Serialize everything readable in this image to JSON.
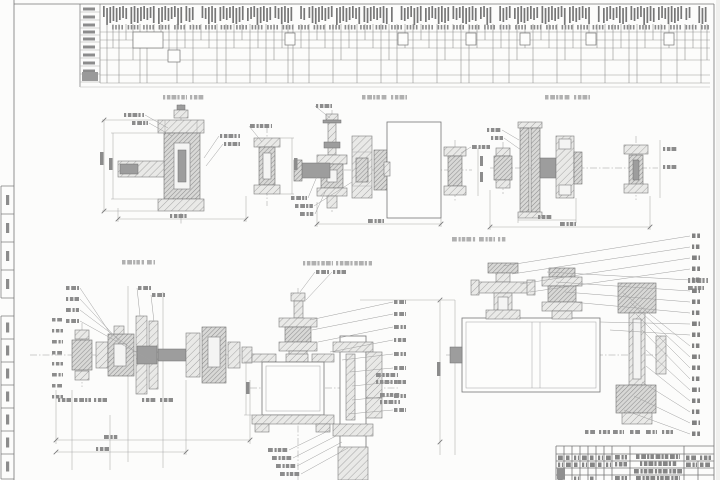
{
  "colors": {
    "paper": "#fcfcfb",
    "outside": "#f0f0ee",
    "line": "#767676",
    "light_line": "#a9a9a9",
    "leader": "#9f9f9f",
    "micro_text": "#777777",
    "micro_text_mid": "#8c8c8c",
    "micro_text_light": "#b0b0b0",
    "grid_row": "#9a9a9a",
    "vertical_line": "#8f8f8f"
  },
  "frame": {
    "left_x": 14,
    "right_x": 714,
    "top_y": 4,
    "margin_strip": {
      "x": 1,
      "width": 13,
      "group1_y": [
        186,
        214,
        242,
        270,
        298
      ],
      "group2_y": [
        316,
        339,
        362,
        385,
        408,
        431,
        454,
        479
      ]
    }
  },
  "cyclogram": {
    "x": 80,
    "label_col_right": 100,
    "right": 710,
    "top": 4,
    "bottom": 83,
    "label_rows": [
      12,
      20,
      28,
      35,
      42,
      50,
      58,
      66,
      74,
      82
    ],
    "text_band": {
      "x1": 103,
      "x2": 708,
      "y": 6,
      "height": 17
    },
    "band2": {
      "y": 25,
      "height": 4.5
    },
    "row_lines": [
      32,
      40,
      48,
      60,
      75,
      83
    ],
    "verticals": [
      [
        107,
        83
      ],
      [
        113,
        48
      ],
      [
        119,
        83
      ],
      [
        126,
        40
      ],
      [
        133,
        60
      ],
      [
        140,
        83
      ],
      [
        147,
        83
      ],
      [
        154,
        48
      ],
      [
        161,
        40
      ],
      [
        169,
        62
      ],
      [
        177,
        83
      ],
      [
        185,
        48
      ],
      [
        193,
        83
      ],
      [
        201,
        40
      ],
      [
        209,
        48
      ],
      [
        217,
        83
      ],
      [
        226,
        83
      ],
      [
        234,
        48
      ],
      [
        242,
        40
      ],
      [
        250,
        83
      ],
      [
        258,
        48
      ],
      [
        266,
        83
      ],
      [
        274,
        60
      ],
      [
        282,
        48
      ],
      [
        288,
        83
      ],
      [
        293,
        83
      ],
      [
        301,
        48
      ],
      [
        309,
        83
      ],
      [
        317,
        40
      ],
      [
        325,
        48
      ],
      [
        333,
        83
      ],
      [
        341,
        60
      ],
      [
        349,
        48
      ],
      [
        357,
        83
      ],
      [
        365,
        40
      ],
      [
        373,
        48
      ],
      [
        381,
        83
      ],
      [
        389,
        60
      ],
      [
        397,
        83
      ],
      [
        405,
        48
      ],
      [
        413,
        83
      ],
      [
        421,
        40
      ],
      [
        429,
        48
      ],
      [
        437,
        83
      ],
      [
        445,
        60
      ],
      [
        453,
        48
      ],
      [
        461,
        83
      ],
      [
        469,
        83
      ],
      [
        477,
        48
      ],
      [
        485,
        40
      ],
      [
        493,
        83
      ],
      [
        501,
        48
      ],
      [
        509,
        83
      ],
      [
        517,
        60
      ],
      [
        525,
        48
      ],
      [
        533,
        83
      ],
      [
        541,
        40
      ],
      [
        549,
        48
      ],
      [
        557,
        83
      ],
      [
        565,
        60
      ],
      [
        573,
        48
      ],
      [
        581,
        83
      ],
      [
        589,
        40
      ],
      [
        597,
        48
      ],
      [
        605,
        83
      ],
      [
        613,
        60
      ],
      [
        621,
        48
      ],
      [
        629,
        83
      ],
      [
        637,
        83
      ],
      [
        645,
        48
      ],
      [
        653,
        40
      ],
      [
        661,
        83
      ],
      [
        669,
        48
      ],
      [
        677,
        83
      ],
      [
        685,
        60
      ],
      [
        693,
        48
      ],
      [
        701,
        83
      ],
      [
        707,
        60
      ]
    ],
    "boxes": [
      [
        133,
        32,
        30,
        16
      ],
      [
        168,
        50,
        12,
        12
      ],
      [
        285,
        33,
        10,
        12
      ],
      [
        398,
        33,
        10,
        12
      ],
      [
        466,
        33,
        10,
        12
      ],
      [
        520,
        33,
        10,
        12
      ],
      [
        586,
        33,
        10,
        12
      ],
      [
        664,
        33,
        10,
        12
      ]
    ],
    "label_block": [
      82,
      72,
      16,
      9
    ]
  },
  "view_titles": [
    {
      "bars": [
        [
          163,
          95,
          24
        ],
        [
          190,
          95,
          14
        ]
      ]
    },
    {
      "bars": [
        [
          362,
          95,
          26
        ],
        [
          391,
          95,
          16
        ]
      ]
    },
    {
      "bars": [
        [
          545,
          95,
          26
        ],
        [
          574,
          95,
          16
        ]
      ]
    },
    {
      "bars": [
        [
          122,
          260,
          22
        ],
        [
          147,
          260,
          8
        ]
      ]
    },
    {
      "bars": [
        [
          303,
          261,
          30
        ],
        [
          336,
          261,
          36
        ]
      ]
    },
    {
      "bars": [
        [
          452,
          237,
          24
        ],
        [
          479,
          237,
          16
        ],
        [
          498,
          237,
          8
        ]
      ]
    }
  ],
  "leaders": [
    {
      "label": [
        124,
        113,
        20
      ],
      "to": [
        168,
        128
      ]
    },
    {
      "label": [
        132,
        121,
        16
      ],
      "to": [
        172,
        136
      ]
    },
    {
      "label": [
        220,
        134,
        20
      ],
      "to": [
        204,
        158
      ]
    },
    {
      "label": [
        224,
        142,
        16
      ],
      "to": [
        206,
        166
      ]
    },
    {
      "label": [
        250,
        124,
        22
      ],
      "to": [
        262,
        142
      ]
    },
    {
      "label": [
        316,
        104,
        16
      ],
      "to": [
        330,
        118
      ]
    },
    {
      "label": [
        291,
        196,
        16
      ],
      "to": [
        318,
        174
      ]
    },
    {
      "label": [
        295,
        204,
        18
      ],
      "to": [
        352,
        182
      ]
    },
    {
      "label": [
        300,
        212,
        14
      ],
      "to": [
        326,
        190
      ]
    },
    {
      "label": [
        472,
        145,
        18
      ],
      "to": [
        461,
        153
      ]
    },
    {
      "label": [
        487,
        128,
        14
      ],
      "to": [
        519,
        140
      ]
    },
    {
      "label": [
        491,
        136,
        12
      ],
      "to": [
        521,
        150
      ]
    },
    {
      "label": [
        66,
        286,
        13
      ],
      "to": [
        112,
        336
      ]
    },
    {
      "label": [
        66,
        297,
        13
      ],
      "to": [
        122,
        344
      ]
    },
    {
      "label": [
        66,
        308,
        13
      ],
      "to": [
        136,
        352
      ]
    },
    {
      "label": [
        66,
        319,
        13
      ],
      "to": [
        150,
        360
      ]
    },
    {
      "label": [
        138,
        286,
        13
      ],
      "to": [
        140,
        316
      ]
    },
    {
      "label": [
        152,
        293,
        13
      ],
      "to": [
        154,
        322
      ]
    },
    {
      "label": [
        316,
        270,
        13
      ],
      "to": [
        300,
        292
      ]
    },
    {
      "label": [
        333,
        270,
        13
      ],
      "to": [
        306,
        300
      ]
    },
    {
      "label": [
        394,
        300,
        12
      ],
      "to": [
        310,
        320
      ]
    },
    {
      "label": [
        394,
        312,
        12
      ],
      "to": [
        312,
        330
      ]
    },
    {
      "label": [
        394,
        325,
        12
      ],
      "to": [
        318,
        342
      ]
    },
    {
      "label": [
        394,
        338,
        12
      ],
      "to": [
        330,
        352
      ]
    },
    {
      "label": [
        394,
        352,
        12
      ],
      "to": [
        342,
        360
      ]
    },
    {
      "label": [
        394,
        366,
        12
      ],
      "to": [
        350,
        372
      ]
    },
    {
      "label": [
        394,
        380,
        12
      ],
      "to": [
        352,
        386
      ]
    },
    {
      "label": [
        394,
        394,
        12
      ],
      "to": [
        352,
        400
      ]
    },
    {
      "label": [
        394,
        408,
        12
      ],
      "to": [
        348,
        414
      ]
    },
    {
      "label": [
        268,
        448,
        20
      ],
      "to": [
        330,
        430
      ]
    },
    {
      "label": [
        272,
        456,
        20
      ],
      "to": [
        336,
        436
      ]
    },
    {
      "label": [
        276,
        464,
        20
      ],
      "to": [
        342,
        442
      ]
    },
    {
      "label": [
        280,
        472,
        20
      ],
      "to": [
        348,
        448
      ]
    }
  ],
  "position_column": {
    "x": 692,
    "items": [
      {
        "y": 236,
        "from": [
          503,
          266
        ]
      },
      {
        "y": 247,
        "from": [
          512,
          274
        ]
      },
      {
        "y": 258,
        "from": [
          520,
          284
        ]
      },
      {
        "y": 269,
        "from": [
          530,
          292
        ]
      },
      {
        "y": 280,
        "from": [
          547,
          272
        ]
      },
      {
        "y": 291,
        "from": [
          556,
          282
        ]
      },
      {
        "y": 302,
        "from": [
          565,
          292
        ]
      },
      {
        "y": 313,
        "from": [
          572,
          302
        ]
      },
      {
        "y": 324,
        "from": [
          600,
          322
        ]
      },
      {
        "y": 335,
        "from": [
          610,
          330
        ]
      },
      {
        "y": 346,
        "from": [
          622,
          292
        ]
      },
      {
        "y": 357,
        "from": [
          630,
          302
        ]
      },
      {
        "y": 368,
        "from": [
          636,
          314
        ]
      },
      {
        "y": 379,
        "from": [
          642,
          330
        ]
      },
      {
        "y": 390,
        "from": [
          646,
          350
        ]
      },
      {
        "y": 401,
        "from": [
          646,
          366
        ]
      },
      {
        "y": 412,
        "from": [
          642,
          382
        ]
      },
      {
        "y": 423,
        "from": [
          634,
          396
        ]
      },
      {
        "y": 434,
        "from": [
          624,
          410
        ]
      }
    ]
  },
  "labels": [
    {
      "x": 100,
      "y": 152,
      "w": 3.5,
      "h": 13
    },
    {
      "x": 109,
      "y": 158,
      "w": 3.5,
      "h": 12
    },
    {
      "x": 170,
      "y": 214,
      "w": 18,
      "h": 4
    },
    {
      "x": 294,
      "y": 158,
      "w": 3.5,
      "h": 12
    },
    {
      "x": 368,
      "y": 219,
      "w": 16,
      "h": 4
    },
    {
      "x": 480,
      "y": 156,
      "w": 3,
      "h": 10
    },
    {
      "x": 480,
      "y": 172,
      "w": 3,
      "h": 10
    },
    {
      "x": 538,
      "y": 215,
      "w": 14,
      "h": 4
    },
    {
      "x": 560,
      "y": 222,
      "w": 16,
      "h": 4
    },
    {
      "x": 663,
      "y": 147,
      "w": 14,
      "h": 4
    },
    {
      "x": 663,
      "y": 165,
      "w": 14,
      "h": 4
    },
    {
      "x": 52,
      "y": 318,
      "w": 11,
      "h": 3.5
    },
    {
      "x": 52,
      "y": 329,
      "w": 11,
      "h": 3.5
    },
    {
      "x": 52,
      "y": 340,
      "w": 11,
      "h": 3.5
    },
    {
      "x": 52,
      "y": 351,
      "w": 11,
      "h": 3.5
    },
    {
      "x": 52,
      "y": 362,
      "w": 11,
      "h": 3.5
    },
    {
      "x": 52,
      "y": 373,
      "w": 11,
      "h": 3.5
    },
    {
      "x": 52,
      "y": 384,
      "w": 11,
      "h": 3.5
    },
    {
      "x": 52,
      "y": 395,
      "w": 11,
      "h": 3.5
    },
    {
      "x": 58,
      "y": 398,
      "w": 13,
      "h": 4
    },
    {
      "x": 74,
      "y": 398,
      "w": 17,
      "h": 4
    },
    {
      "x": 94,
      "y": 398,
      "w": 13,
      "h": 4
    },
    {
      "x": 142,
      "y": 398,
      "w": 15,
      "h": 4
    },
    {
      "x": 160,
      "y": 398,
      "w": 13,
      "h": 4
    },
    {
      "x": 104,
      "y": 435,
      "w": 15,
      "h": 4
    },
    {
      "x": 96,
      "y": 447,
      "w": 13,
      "h": 4
    },
    {
      "x": 437,
      "y": 362,
      "w": 3.5,
      "h": 14
    },
    {
      "x": 246,
      "y": 382,
      "w": 3.5,
      "h": 12
    },
    {
      "x": 376,
      "y": 373,
      "w": 22,
      "h": 4
    },
    {
      "x": 376,
      "y": 380,
      "w": 22,
      "h": 4
    },
    {
      "x": 380,
      "y": 393,
      "w": 20,
      "h": 4
    },
    {
      "x": 380,
      "y": 400,
      "w": 20,
      "h": 4
    },
    {
      "x": 688,
      "y": 278,
      "w": 20,
      "h": 5
    },
    {
      "x": 688,
      "y": 286,
      "w": 16,
      "h": 4
    },
    {
      "x": 585,
      "y": 430,
      "w": 11,
      "h": 4
    },
    {
      "x": 599,
      "y": 430,
      "w": 11,
      "h": 4
    },
    {
      "x": 613,
      "y": 430,
      "w": 11,
      "h": 4
    },
    {
      "x": 630,
      "y": 430,
      "w": 11,
      "h": 4
    },
    {
      "x": 646,
      "y": 430,
      "w": 11,
      "h": 4
    },
    {
      "x": 662,
      "y": 430,
      "w": 11,
      "h": 4
    }
  ],
  "title_block": {
    "x1": 556,
    "x2": 714,
    "top": 446,
    "h_lines": [
      446,
      454,
      461,
      468,
      475
    ],
    "v_lines": [
      556,
      564,
      572,
      580,
      588,
      596,
      604,
      612,
      630,
      684
    ],
    "v_partial": [
      {
        "x": 698,
        "y1": 461,
        "y2": 480
      }
    ],
    "cell_texts": [
      [
        558,
        455.5,
        5
      ],
      [
        566,
        455.5,
        5
      ],
      [
        574,
        455.5,
        5
      ],
      [
        582,
        455.5,
        5
      ],
      [
        590,
        455.5,
        5
      ],
      [
        598,
        455.5,
        5
      ],
      [
        606,
        455.5,
        5
      ],
      [
        615,
        455,
        12
      ],
      [
        636,
        454.5,
        44
      ],
      [
        686,
        455.5,
        11
      ],
      [
        700,
        455.5,
        11
      ],
      [
        558,
        462.5,
        5
      ],
      [
        566,
        462.5,
        5
      ],
      [
        574,
        462.5,
        5
      ],
      [
        582,
        462.5,
        5
      ],
      [
        590,
        462.5,
        5
      ],
      [
        598,
        462.5,
        5
      ],
      [
        606,
        462.5,
        5
      ],
      [
        615,
        462,
        12
      ],
      [
        640,
        461.5,
        38
      ],
      [
        686,
        462.5,
        11
      ],
      [
        700,
        462.5,
        11
      ],
      [
        558,
        476.5,
        5
      ],
      [
        574,
        476.5,
        5
      ],
      [
        590,
        476.5,
        5
      ],
      [
        615,
        476,
        12
      ],
      [
        636,
        476,
        44
      ],
      [
        634,
        469,
        48
      ]
    ],
    "dark_cell": [
      557,
      468.5,
      8,
      11
    ]
  }
}
